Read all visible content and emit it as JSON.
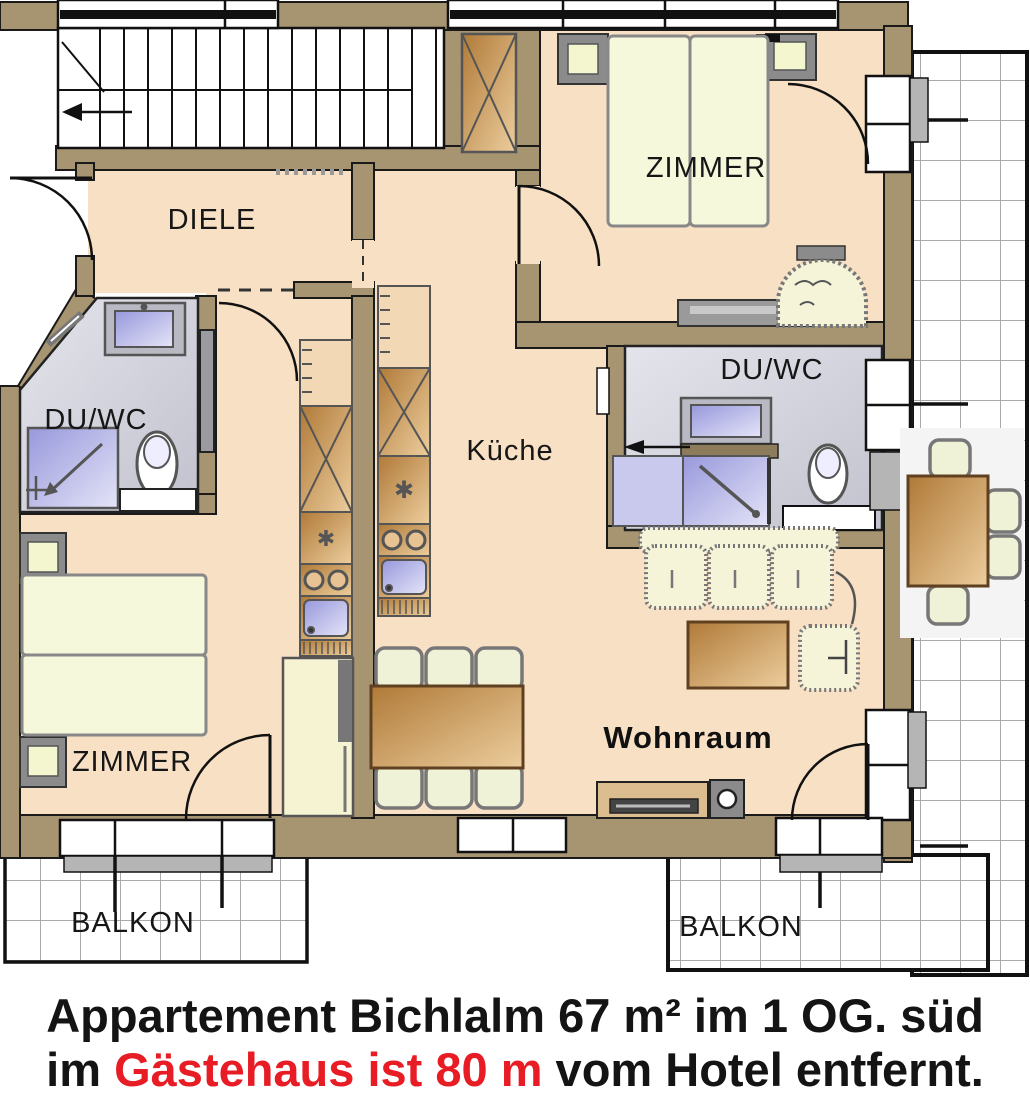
{
  "plan": {
    "rooms": {
      "diele": "DIELE",
      "zimmer_top": "ZIMMER",
      "zimmer_left": "ZIMMER",
      "duwc_left": "DU/WC",
      "duwc_right": "DU/WC",
      "kueche": "Küche",
      "wohnraum": "Wohnraum",
      "balkon_left": "BALKON",
      "balkon_right": "BALKON"
    },
    "symbols": {
      "freezer_star": "✱"
    },
    "colors": {
      "wall": "#a79572",
      "floor": "#f8e0c4",
      "bath_tile": "#cfcfda",
      "balcony_grid": "#aaaaaa",
      "fixture_blue": "#9b9bdd",
      "wood": "#b5803e",
      "highlight_red": "#e81c24"
    }
  },
  "caption": {
    "line1": "Appartement Bichlalm 67 m² im 1 OG. süd",
    "line2_part1": "im ",
    "line2_part2": "Gästehaus ist 80 m",
    "line2_part3": " vom Hotel entfernt."
  }
}
